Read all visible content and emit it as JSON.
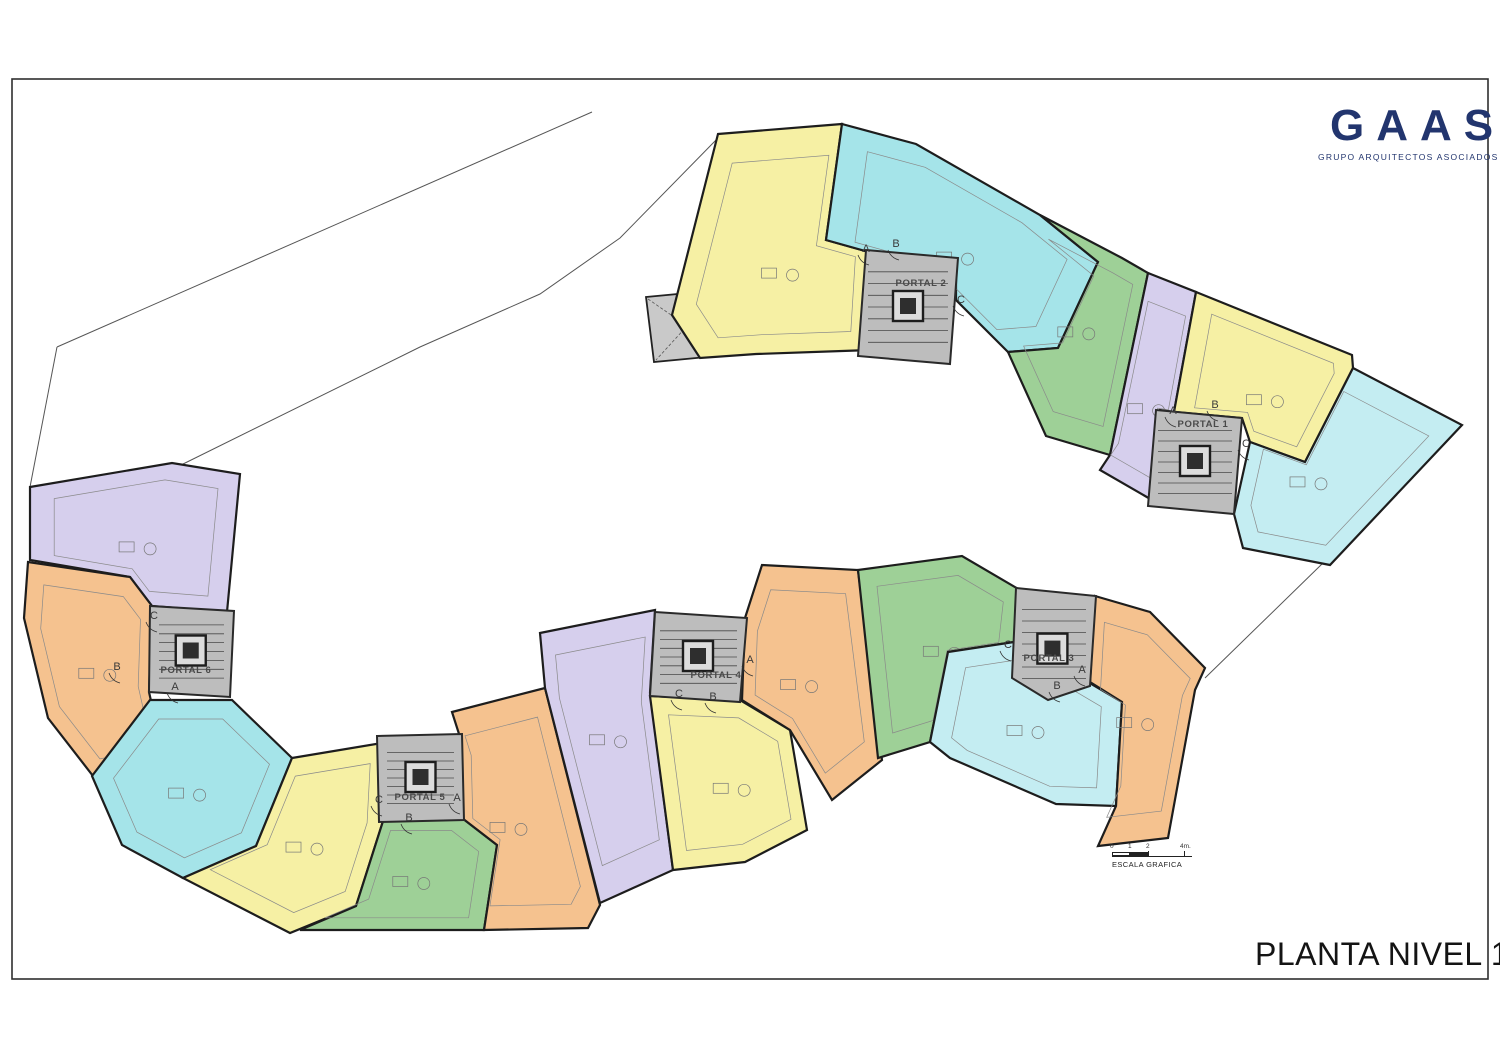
{
  "sheet": {
    "logo": {
      "text": "GAAS",
      "subtitle": "GRUPO ARQUITECTOS ASOCIADOS",
      "color": "#22356e"
    },
    "title": "PLANTA NIVEL 1",
    "scale": {
      "caption": "ESCALA GRAFICA",
      "ticks": [
        "0",
        "1",
        "2",
        "4m."
      ]
    }
  },
  "plan": {
    "colors": {
      "yellow": "#f6f0a4",
      "cyan": "#a5e4e9",
      "cyanLight": "#c4edf2",
      "green": "#9ed097",
      "purple": "#d6cfed",
      "orange": "#f5c28f",
      "core": "#bdbdbd",
      "store": "#c9c9c9",
      "wall": "#1d1d1d",
      "boundary": "#555555"
    },
    "portals": [
      {
        "id": "portal-1",
        "label": "PORTAL 1",
        "label_pos": [
          1203,
          427
        ],
        "letters": [
          [
            "A",
            1173,
            414
          ],
          [
            "B",
            1215,
            408
          ],
          [
            "C",
            1246,
            447
          ]
        ]
      },
      {
        "id": "portal-2",
        "label": "PORTAL 2",
        "label_pos": [
          921,
          286
        ],
        "letters": [
          [
            "A",
            866,
            252
          ],
          [
            "B",
            896,
            247
          ],
          [
            "C",
            961,
            303
          ]
        ]
      },
      {
        "id": "portal-3",
        "label": "PORTAL 3",
        "label_pos": [
          1049,
          661
        ],
        "letters": [
          [
            "A",
            1082,
            673
          ],
          [
            "B",
            1057,
            689
          ],
          [
            "C",
            1008,
            648
          ]
        ]
      },
      {
        "id": "portal-4",
        "label": "PORTAL 4",
        "label_pos": [
          716,
          678
        ],
        "letters": [
          [
            "A",
            750,
            663
          ],
          [
            "B",
            713,
            700
          ],
          [
            "C",
            679,
            697
          ]
        ]
      },
      {
        "id": "portal-5",
        "label": "PORTAL 5",
        "label_pos": [
          420,
          800
        ],
        "letters": [
          [
            "A",
            457,
            801
          ],
          [
            "B",
            409,
            821
          ],
          [
            "C",
            379,
            803
          ]
        ]
      },
      {
        "id": "portal-6",
        "label": "PORTAL 6",
        "label_pos": [
          186,
          673
        ],
        "letters": [
          [
            "A",
            175,
            690
          ],
          [
            "B",
            117,
            670
          ],
          [
            "C",
            154,
            619
          ]
        ]
      }
    ],
    "units": [
      {
        "id": "p2a",
        "portal": 2,
        "letter": "A",
        "color": "yellow"
      },
      {
        "id": "p2b",
        "portal": 2,
        "letter": "B",
        "color": "cyan"
      },
      {
        "id": "p2c",
        "portal": 2,
        "letter": "C",
        "color": "green"
      },
      {
        "id": "p1a",
        "portal": 1,
        "letter": "A",
        "color": "purple"
      },
      {
        "id": "p1b",
        "portal": 1,
        "letter": "B",
        "color": "yellow"
      },
      {
        "id": "p1c",
        "portal": 1,
        "letter": "C",
        "color": "cyanLight"
      },
      {
        "id": "p6c",
        "portal": 6,
        "letter": "C",
        "color": "purple"
      },
      {
        "id": "p6b",
        "portal": 6,
        "letter": "B",
        "color": "orange"
      },
      {
        "id": "p6a",
        "portal": 6,
        "letter": "A",
        "color": "cyan"
      },
      {
        "id": "p5c",
        "portal": 5,
        "letter": "C",
        "color": "yellow"
      },
      {
        "id": "p5b",
        "portal": 5,
        "letter": "B",
        "color": "green"
      },
      {
        "id": "p5a",
        "portal": 5,
        "letter": "A",
        "color": "orange"
      },
      {
        "id": "p4c",
        "portal": 4,
        "letter": "C",
        "color": "purple"
      },
      {
        "id": "p4b",
        "portal": 4,
        "letter": "B",
        "color": "yellow"
      },
      {
        "id": "p4a",
        "portal": 4,
        "letter": "A",
        "color": "orange"
      },
      {
        "id": "p3c",
        "portal": 3,
        "letter": "C",
        "color": "green"
      },
      {
        "id": "p3b",
        "portal": 3,
        "letter": "B",
        "color": "cyanLight"
      },
      {
        "id": "p3a",
        "portal": 3,
        "letter": "A",
        "color": "orange"
      }
    ]
  }
}
